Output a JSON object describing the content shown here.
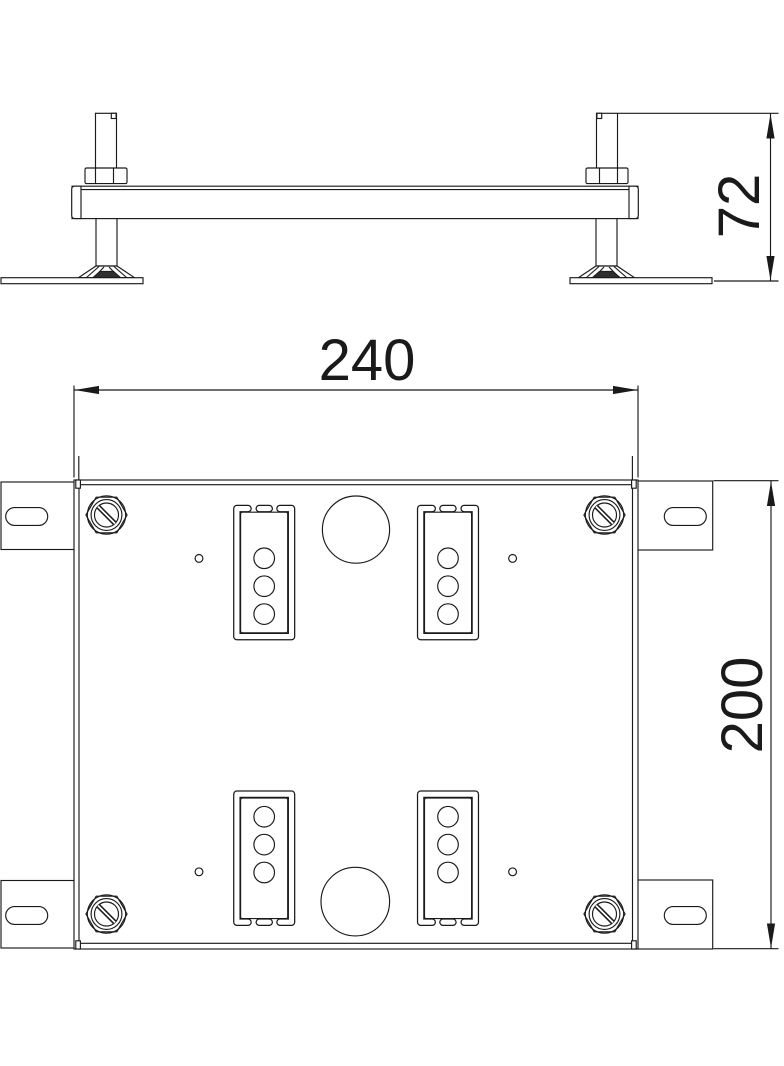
{
  "drawing": {
    "background_color": "#ffffff",
    "line_color": "#1a1a1a",
    "dark_fill_color": "#2e2e2e",
    "dimensions": {
      "side_view_height": "72",
      "plan_view_width": "240",
      "plan_view_height": "200"
    }
  }
}
